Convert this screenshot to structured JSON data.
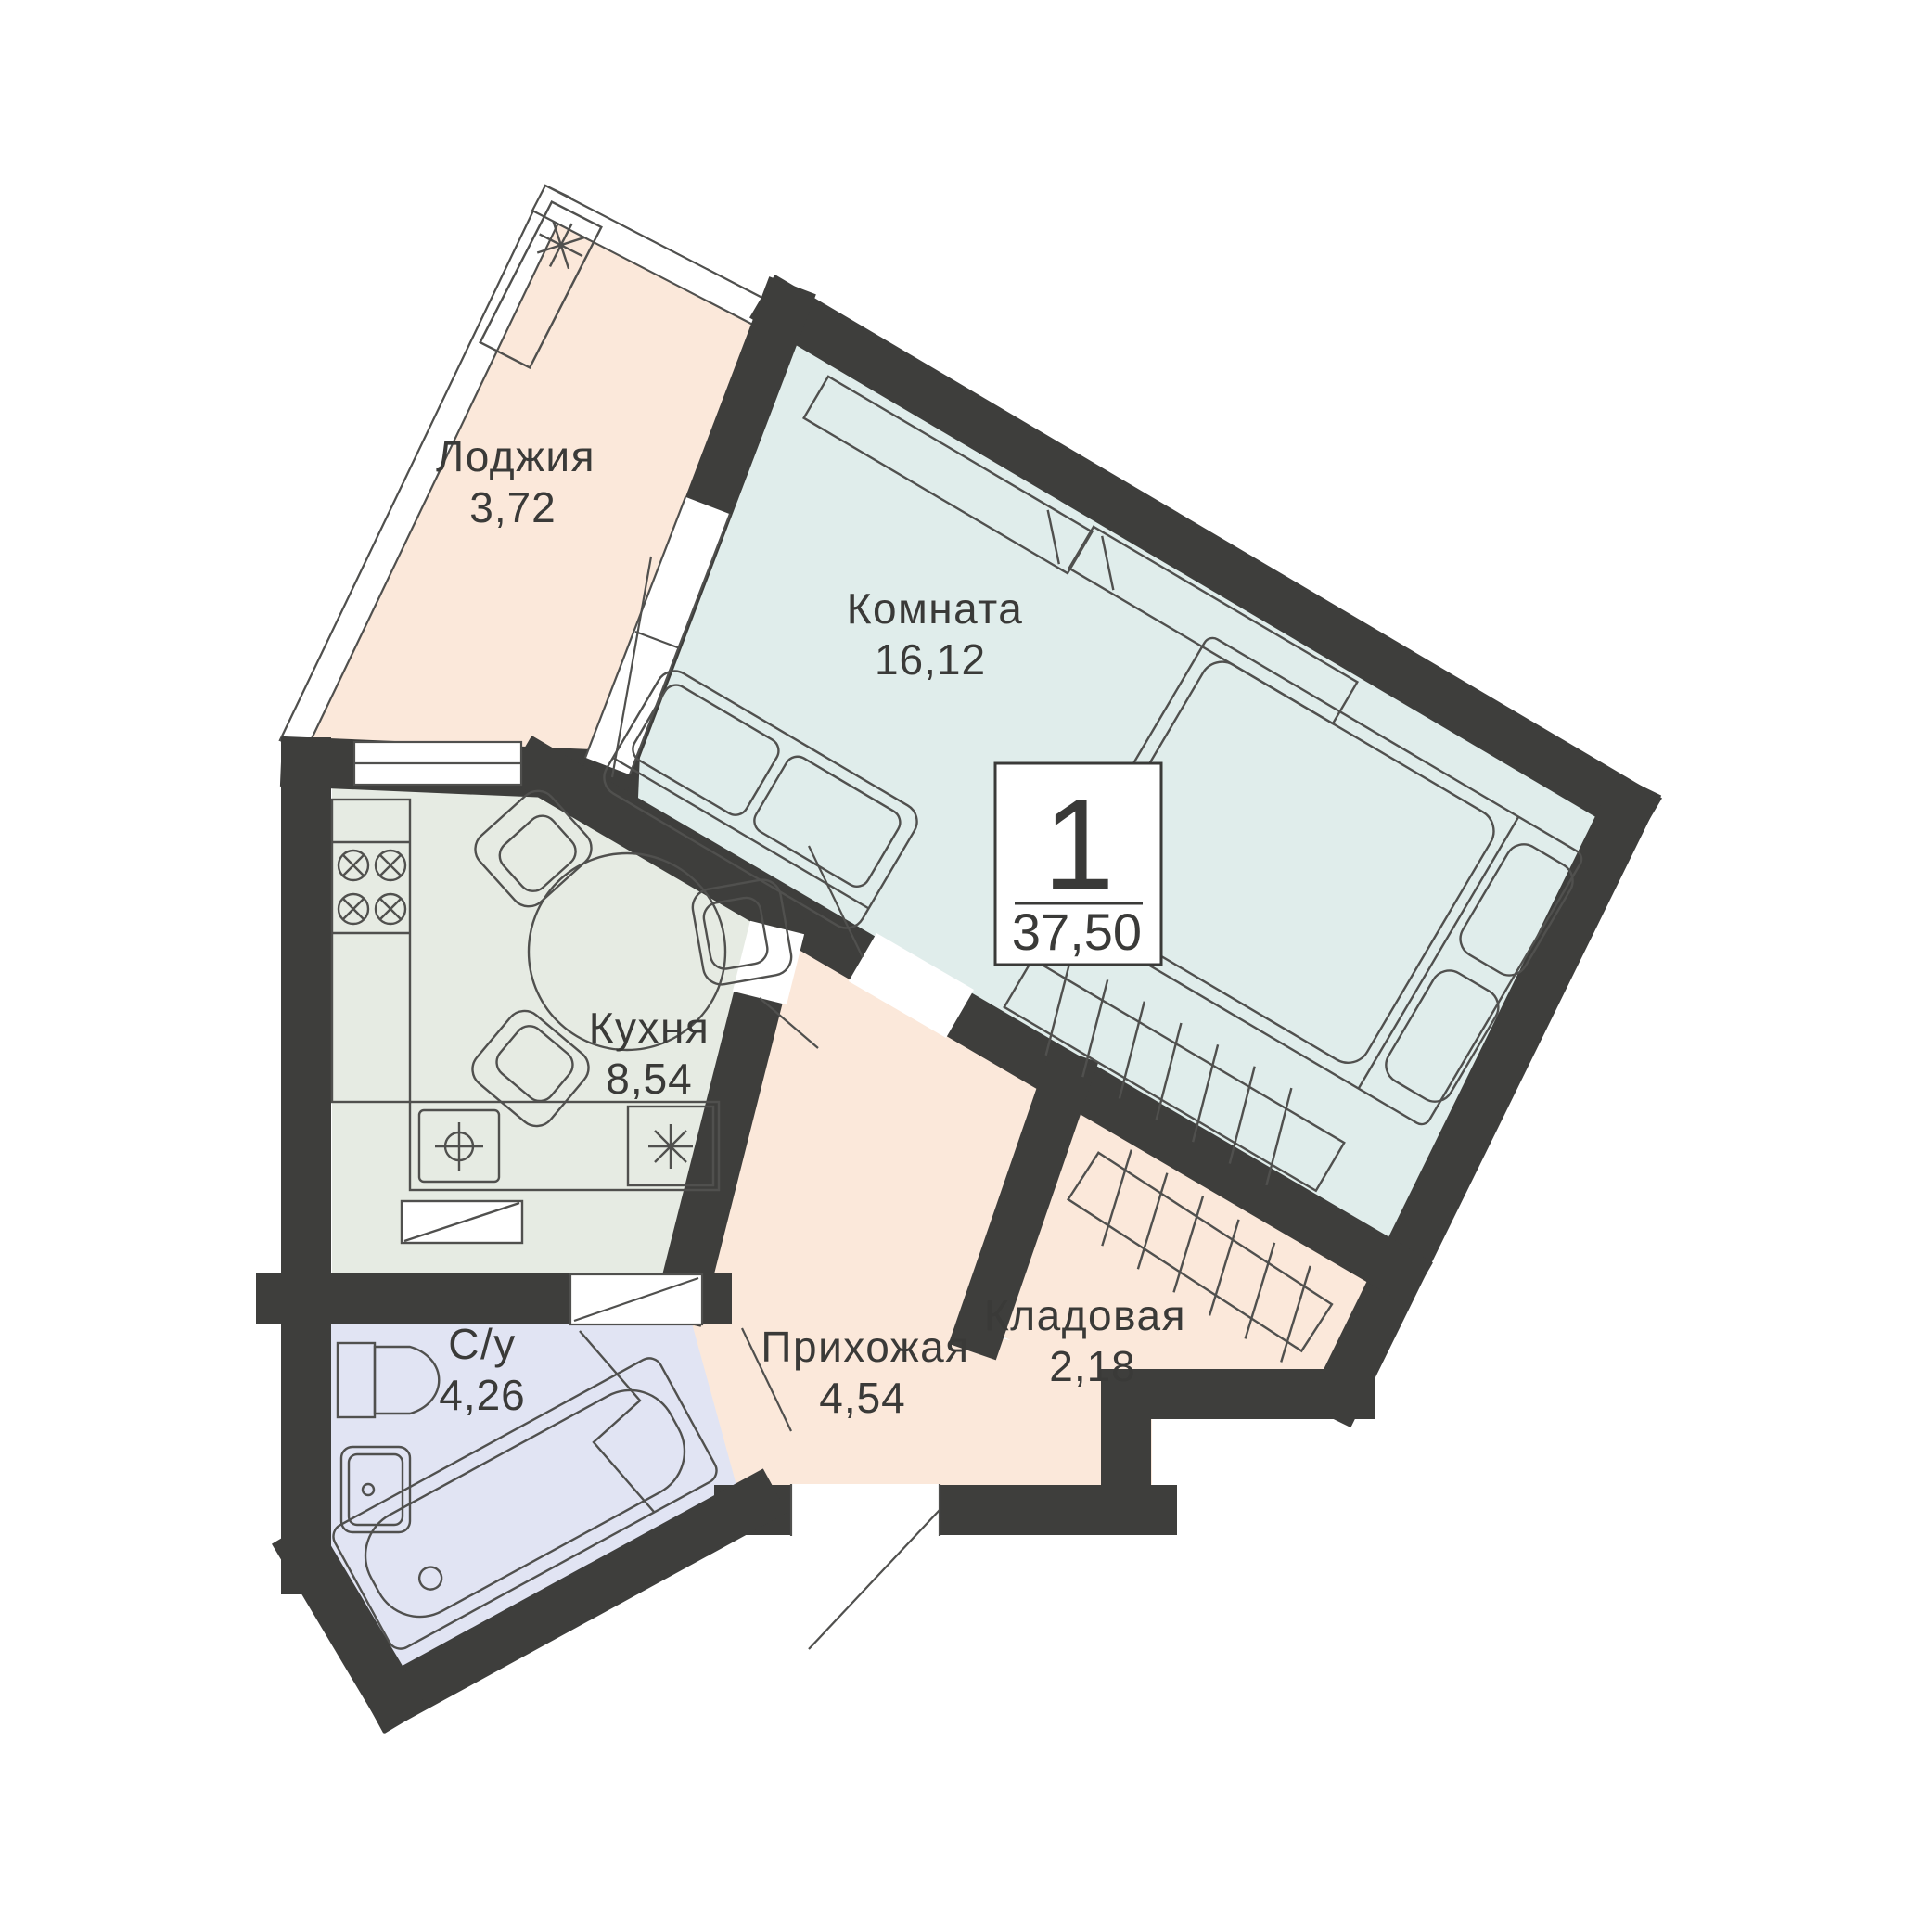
{
  "badge": {
    "rooms_count": "1",
    "total_area": "37,50"
  },
  "rooms": {
    "loggia": {
      "label": "Лоджия",
      "area": "3,72"
    },
    "living": {
      "label": "Комната",
      "area": "16,12"
    },
    "kitchen": {
      "label": "Кухня",
      "area": "8,54"
    },
    "bathroom": {
      "label": "С/у",
      "area": "4,26"
    },
    "hallway": {
      "label": "Прихожая",
      "area": "4,54"
    },
    "storage": {
      "label": "Кладовая",
      "area": "2,18"
    }
  },
  "colors": {
    "background": "#ffffff",
    "wall": "#3e3e3c",
    "loggia_fill": "#fbe8da",
    "living_fill": "#e0edeb",
    "kitchen_fill": "#e6ebe3",
    "bathroom_fill": "#e1e4f3",
    "hallway_fill": "#fbe8da",
    "storage_fill": "#fbe8da",
    "furniture_line": "#50504e",
    "glazing_fill": "#ffffff"
  }
}
